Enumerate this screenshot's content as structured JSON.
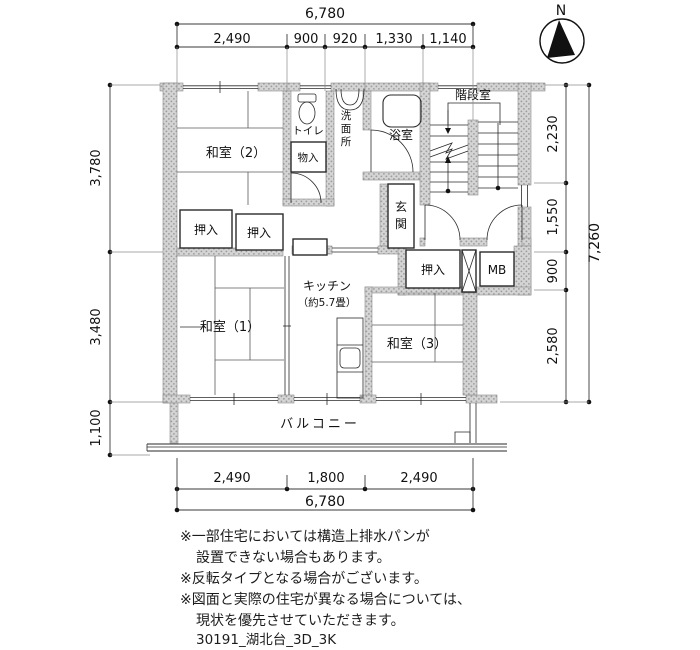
{
  "compass": {
    "label": "N"
  },
  "dimensions": {
    "top": {
      "total": "6,780",
      "segments": [
        "2,490",
        "900",
        "920",
        "1,330",
        "1,140"
      ]
    },
    "left": {
      "segments": [
        "3,780",
        "3,480",
        "1,100"
      ]
    },
    "right": {
      "total": "7,260",
      "segments": [
        "2,230",
        "1,550",
        "900",
        "2,580"
      ]
    },
    "bottom": {
      "total": "6,780",
      "segments": [
        "2,490",
        "1,800",
        "2,490"
      ]
    }
  },
  "rooms": {
    "washitsu2": "和室（2）",
    "washitsu1": "和室（1）",
    "washitsu3": "和室（3）",
    "kitchen": "キッチン",
    "kitchen_size": "（約5.7畳）",
    "toilet": "トイレ",
    "washroom_chars": [
      "洗",
      "面",
      "所"
    ],
    "bath": "浴室",
    "stairwell": "階段室",
    "entrance_chars": [
      "玄",
      "関"
    ],
    "storage": "物入",
    "closet_a": "押入",
    "closet_b": "押入",
    "closet_c": "押入",
    "meter_box": "MB",
    "balcony": "バルコニー"
  },
  "notes": [
    "※一部住宅においては構造上排水パンが",
    "設置できない場合もあります。",
    "※反転タイプとなる場合がございます。",
    "※図面と実際の住宅が異なる場合については、",
    "現状を優先させていただきます。"
  ],
  "footer": "30191_湖北台_3D_3K",
  "colors": {
    "wall": "#d2d2d2",
    "line": "#2a2a2a"
  }
}
